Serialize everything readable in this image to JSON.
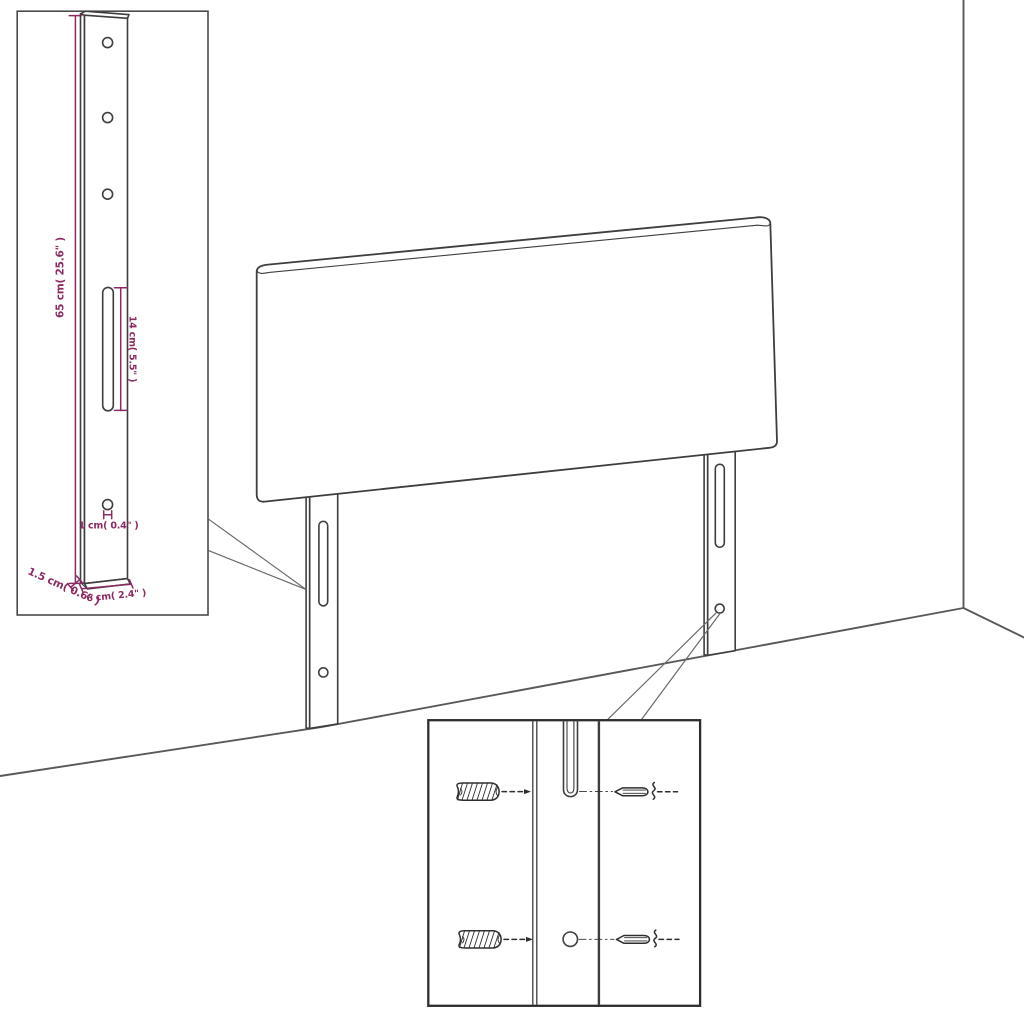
{
  "labels": {
    "bracket_height": "65 cm( 25.6\" )",
    "slot_length": "14 cm( 5.5\" )",
    "hole_diameter": "1 cm( 0.4\" )",
    "bracket_depth": "1.5 cm( 0.6\" )",
    "bracket_width": "6 cm( 2.4\" )"
  },
  "colors": {
    "dimension": "#8b2b63",
    "outline": "#3e3e3e",
    "wall": "#58595b",
    "leader": "#6a6a6a",
    "inset_border": "#4a4a4a",
    "inset_border_strong": "#2d2d2d",
    "hardware": "#2e2e2e",
    "background": "#ffffff"
  }
}
